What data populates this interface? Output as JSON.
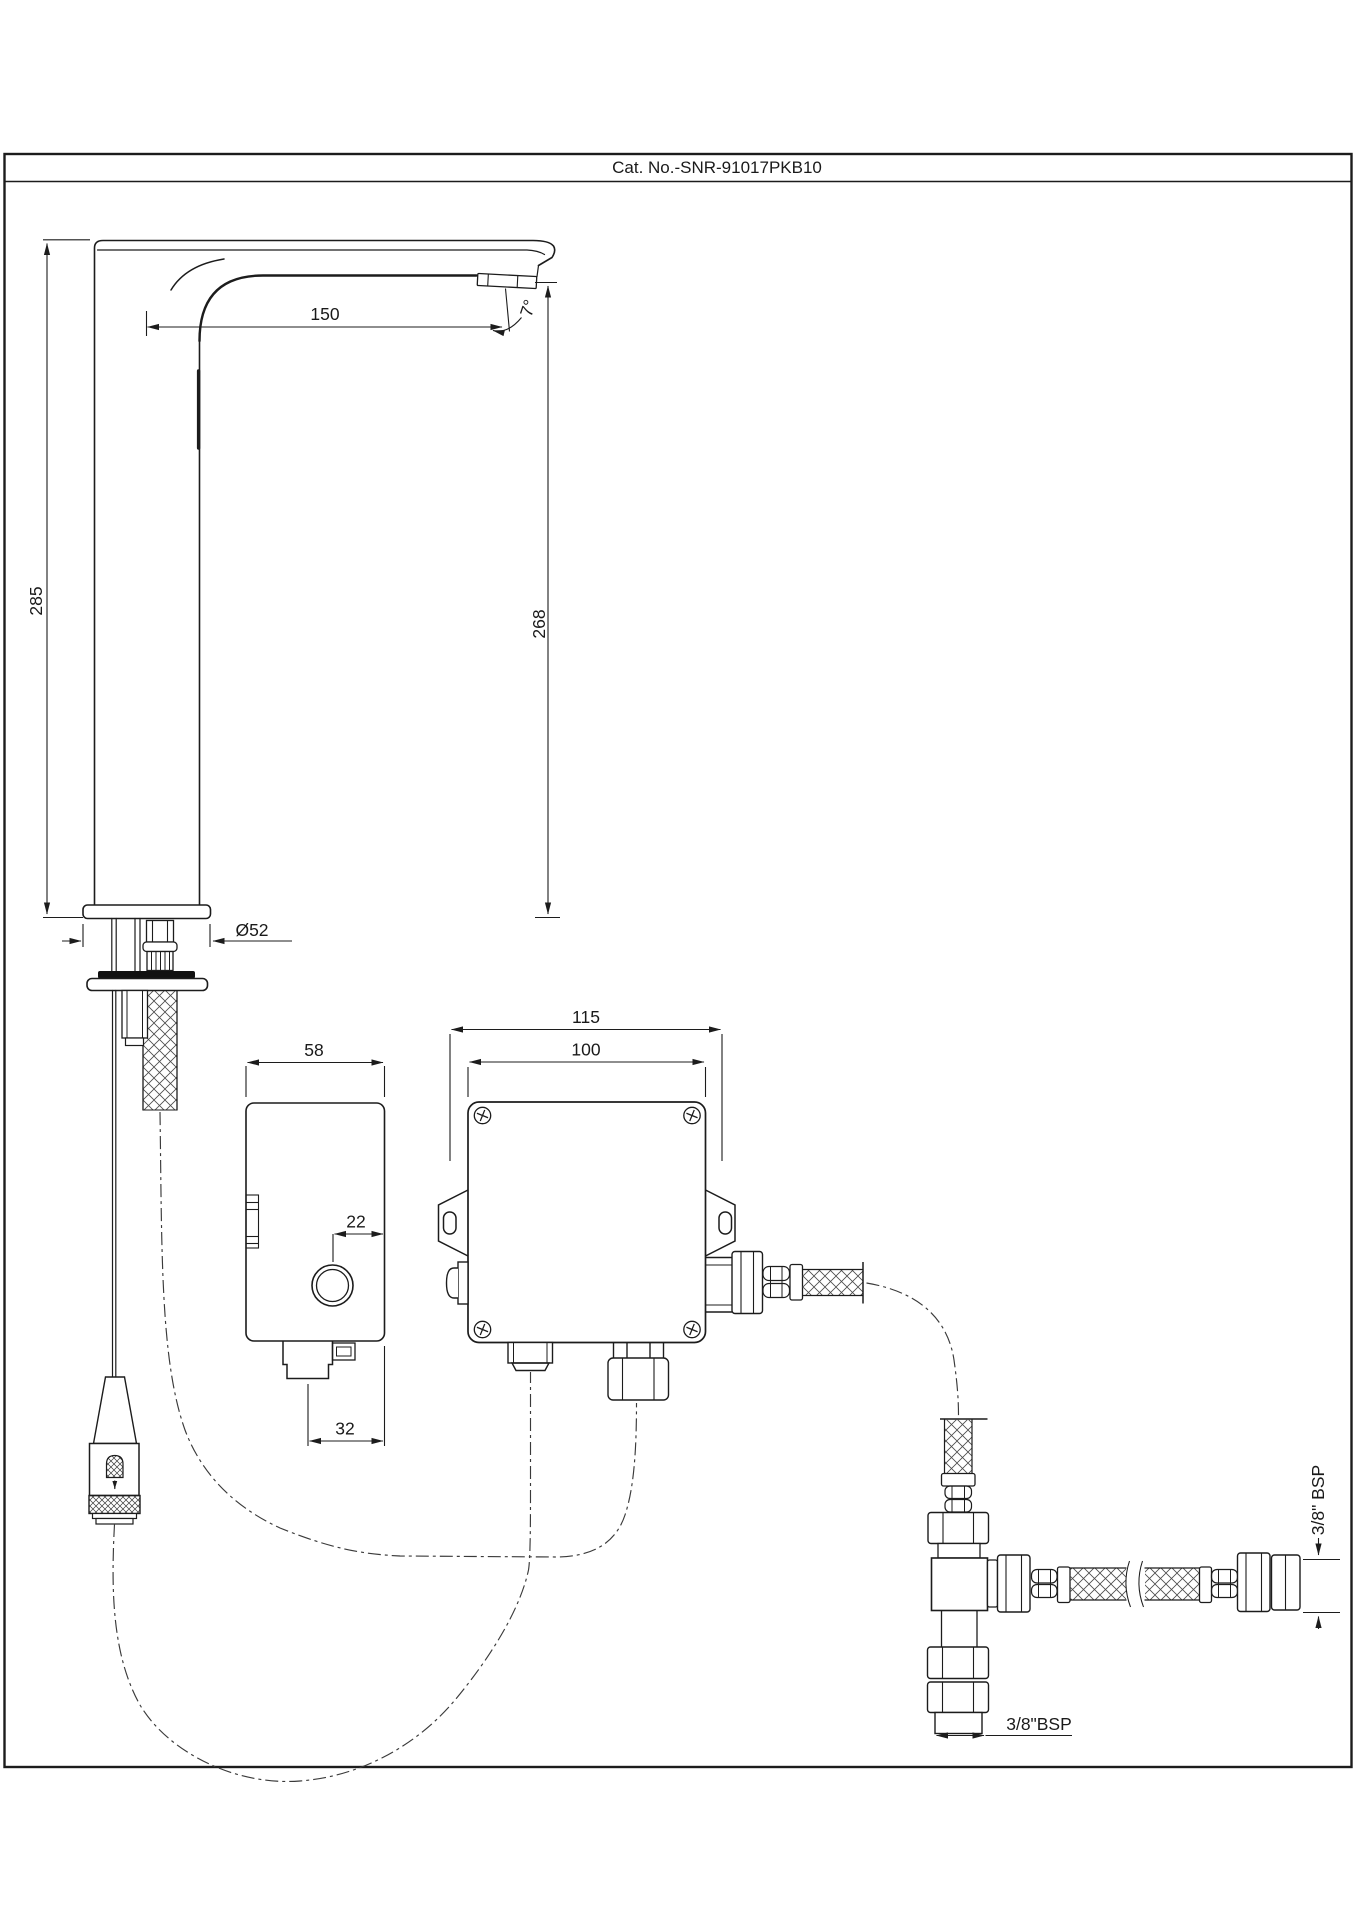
{
  "title": "Cat. No.-SNR-91017PKB10",
  "colors": {
    "line": "#1c1c1c",
    "background": "#ffffff",
    "seal": "#111111"
  },
  "dimensions": {
    "faucet_height": "285",
    "spout_height": "268",
    "spout_reach": "150",
    "spout_angle": "7°",
    "base_diameter": "Ø52",
    "control_unit_width": "58",
    "button_offset": "22",
    "connector_offset": "32",
    "mounting_width": "115",
    "box_width": "100",
    "inlet_thread": "3/8\" BSP",
    "outlet_thread": "3/8\"BSP"
  }
}
